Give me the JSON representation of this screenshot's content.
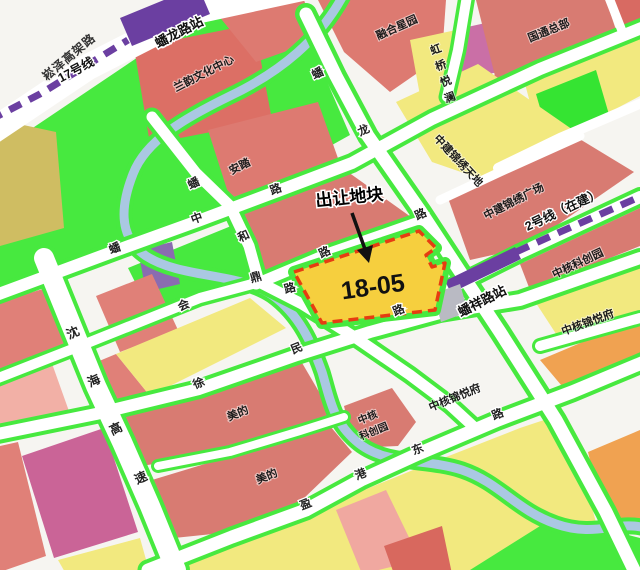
{
  "parcel": {
    "code": "18-05",
    "callout": "出让地块",
    "fill": "#f6cf3e",
    "border_color": "#e63c11"
  },
  "stations": [
    {
      "id": "panlong-road-station",
      "name": "蟠龙路站"
    },
    {
      "id": "panxiang-road-station",
      "name": "蟠祥路站"
    }
  ],
  "metro_lines": [
    {
      "id": "line-17",
      "name": "17号线",
      "color": "#6b3fa1"
    },
    {
      "id": "line-2-under-construction",
      "name": "2号线（在建）",
      "color": "#6b3fa1"
    }
  ],
  "roads": [
    {
      "id": "songze-elevated-road",
      "name": "崧泽高架路"
    },
    {
      "id": "shenhai-expressway",
      "name": "沈海高速",
      "chars": [
        "沈",
        "海",
        "高",
        "速"
      ]
    },
    {
      "id": "panlong-road",
      "name": "蟠龙路",
      "chars": [
        "蟠",
        "龙",
        "路"
      ]
    },
    {
      "id": "panzhong-road",
      "name": "蟠中路",
      "chars": [
        "蟠",
        "中",
        "路"
      ]
    },
    {
      "id": "panheding-road",
      "name": "蟠和鼎路",
      "chars": [
        "蟠",
        "和",
        "鼎",
        "路"
      ]
    },
    {
      "id": "parcel-north-road",
      "name": "路",
      "chars": [
        "路"
      ]
    },
    {
      "id": "hui-road",
      "name": "会",
      "chars": [
        "会"
      ]
    },
    {
      "id": "xumin-road",
      "name": "徐民路",
      "chars": [
        "徐",
        "民",
        "路"
      ]
    },
    {
      "id": "yinggang-east-road",
      "name": "盈港东路",
      "chars": [
        "盈",
        "港",
        "东",
        "路"
      ]
    }
  ],
  "places": [
    {
      "id": "lanyun-culture-center",
      "name": "兰韵文化中心"
    },
    {
      "id": "anta",
      "name": "安踏"
    },
    {
      "id": "ronghe-xingyuan",
      "name": "融合星园"
    },
    {
      "id": "hongqiao-yuelan",
      "name": "虹桥悦澜",
      "chars": [
        "虹",
        "桥",
        "悦",
        "澜"
      ]
    },
    {
      "id": "guotong-headquarters",
      "name": "国通总部"
    },
    {
      "id": "zhongjian-jinxiu-tiandi",
      "name": "中建锦绣天地"
    },
    {
      "id": "zhongjian-jinxiu-plaza",
      "name": "中建锦绣广场"
    },
    {
      "id": "zhonghe-kechuang-park-east",
      "name": "中核科创园"
    },
    {
      "id": "zhonghe-jinyue-mansion-east",
      "name": "中核锦悦府"
    },
    {
      "id": "zhonghe-jinyue-mansion-mid",
      "name": "中核锦悦府"
    },
    {
      "id": "zhonghe-kechuang-park-south",
      "name": "中核科创园",
      "line1": "中核",
      "line2": "科创园"
    },
    {
      "id": "midea-north",
      "name": "美的"
    },
    {
      "id": "midea-south",
      "name": "美的"
    }
  ],
  "colors": {
    "road_white": "#ffffff",
    "greenery": "#47e93f",
    "water": "#aac8e2",
    "residential_red": "#dd7a71",
    "light_pink": "#f0a8a0",
    "commercial_yellow": "#f2e97f",
    "orange": "#f0a251",
    "magenta_block": "#ca6497",
    "olive_block": "#cfbd62",
    "purple_metro": "#6b3fa1",
    "purple_block": "#8a6cb0",
    "station_gray": "#b9bac3",
    "parcel_yellow": "#f6cf3e",
    "parcel_border_red": "#e63c11"
  }
}
